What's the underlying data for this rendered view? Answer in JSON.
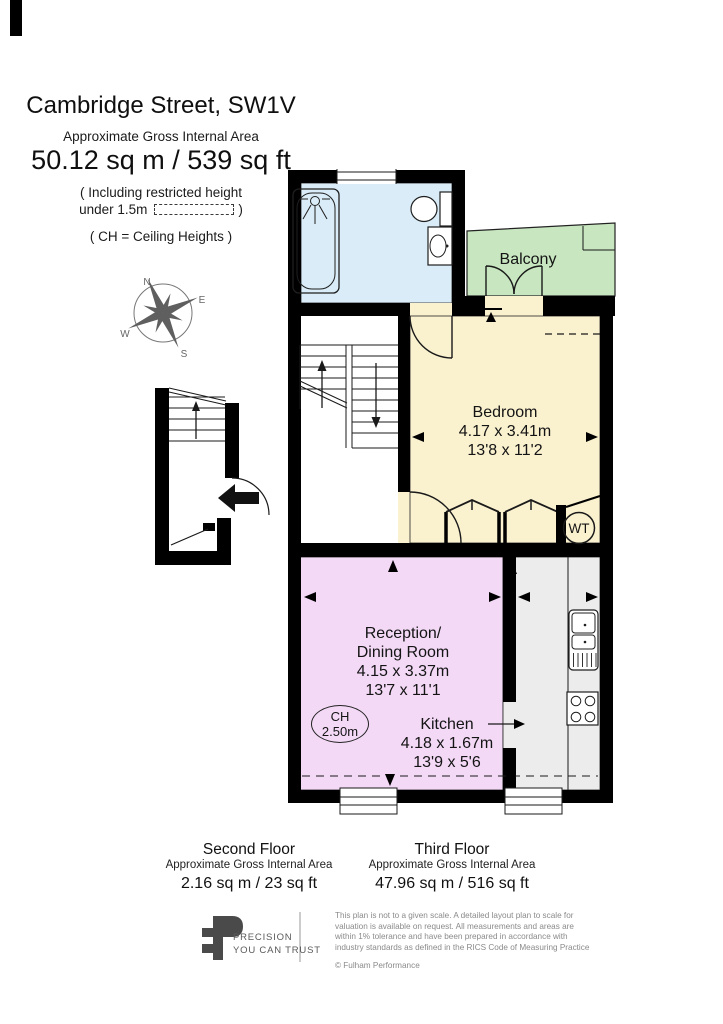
{
  "page": {
    "title": "Cambridge Street, SW1V",
    "subtitle": "Approximate Gross Internal Area",
    "total_area": "50.12 sq m  /  539 sq ft",
    "note_line1": "( Including restricted height",
    "note_line2_prefix": "under 1.5m",
    "note_line2_suffix": ")",
    "ch_note": "( CH = Ceiling Heights )"
  },
  "compass": {
    "n": "N",
    "e": "E",
    "s": "S",
    "w": "W"
  },
  "rooms": {
    "balcony": {
      "label": "Balcony"
    },
    "bedroom": {
      "label": "Bedroom",
      "metric": "4.17 x 3.41m",
      "imperial": "13'8 x 11'2"
    },
    "reception": {
      "label_line1": "Reception/",
      "label_line2": "Dining Room",
      "metric": "4.15 x 3.37m",
      "imperial": "13'7 x 11'1"
    },
    "kitchen": {
      "label": "Kitchen",
      "metric": "4.18 x 1.67m",
      "imperial": "13'9 x 5'6"
    },
    "ceiling_height": {
      "line1": "CH",
      "line2": "2.50m"
    },
    "water_tank": {
      "label": "WT"
    }
  },
  "floors": {
    "second": {
      "name": "Second Floor",
      "subtitle": "Approximate Gross Internal Area",
      "area": "2.16 sq m  /  23 sq ft"
    },
    "third": {
      "name": "Third Floor",
      "subtitle": "Approximate Gross Internal Area",
      "area": "47.96 sq m  /  516 sq ft"
    }
  },
  "footer": {
    "brand_line1": "PRECISION",
    "brand_line2": "YOU CAN TRUST",
    "disclaimer_line1": "This plan is not to a given scale. A detailed layout plan to scale for",
    "disclaimer_line2": "valuation is available on request. All measurements and areas are",
    "disclaimer_line3": "within 1% tolerance and have been prepared in accordance with",
    "disclaimer_line4": "industry standards as defined in the RICS Code of Measuring Practice",
    "copyright": "© Fulham Performance"
  },
  "colors": {
    "wall": "#000000",
    "bathroom": "#d9ecf7",
    "balcony": "#c8e7c0",
    "bedroom": "#faf1cf",
    "reception": "#f3d9f6",
    "kitchen": "#ececec",
    "logo_gray": "#4a4a4a"
  }
}
